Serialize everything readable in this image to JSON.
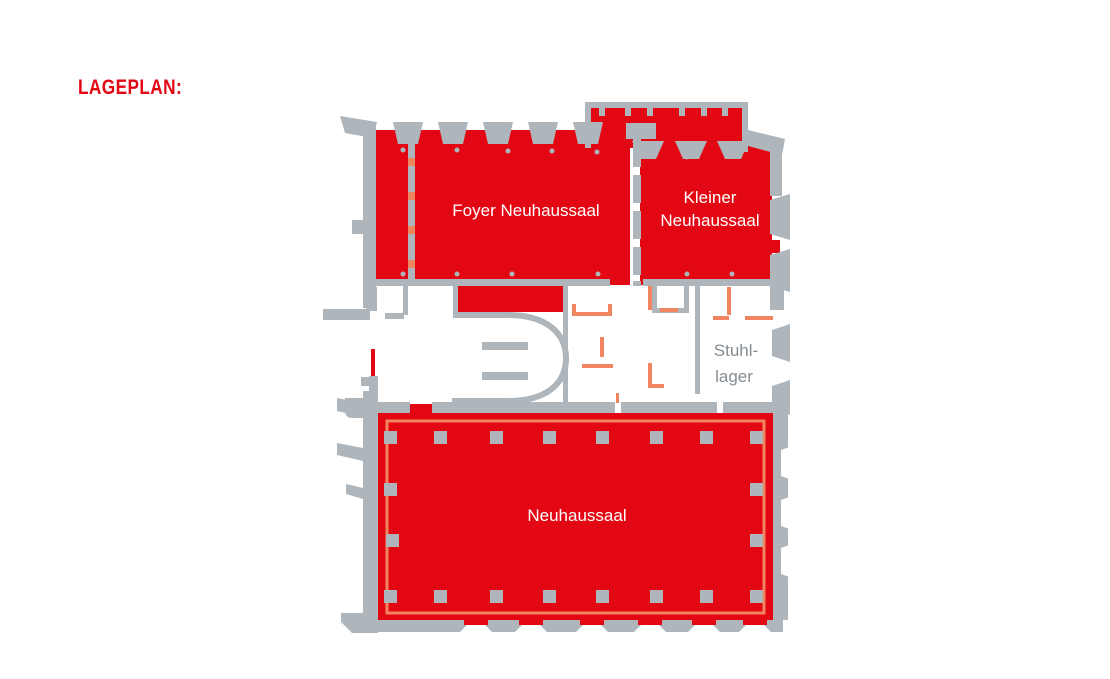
{
  "page": {
    "title": "LAGEPLAN:",
    "background": "#FFFFFF"
  },
  "floorplan": {
    "rooms": {
      "foyer": {
        "label": "Foyer Neuhaussaal",
        "highlighted": true
      },
      "kleiner": {
        "label_line1": "Kleiner",
        "label_line2": "Neuhaussaal",
        "highlighted": true
      },
      "neuhaussaal": {
        "label": "Neuhaussaal",
        "highlighted": true
      },
      "stuhllager": {
        "label_line1": "Stuhl-",
        "label_line2": "lager",
        "highlighted": false
      }
    },
    "colors": {
      "highlight_red": "#E30613",
      "door_salmon": "#F08560",
      "wall_gray": "#AEB5BB",
      "room_label": "#FFFFFF",
      "muted_label": "#858D93",
      "title_red": "#E30613"
    }
  }
}
